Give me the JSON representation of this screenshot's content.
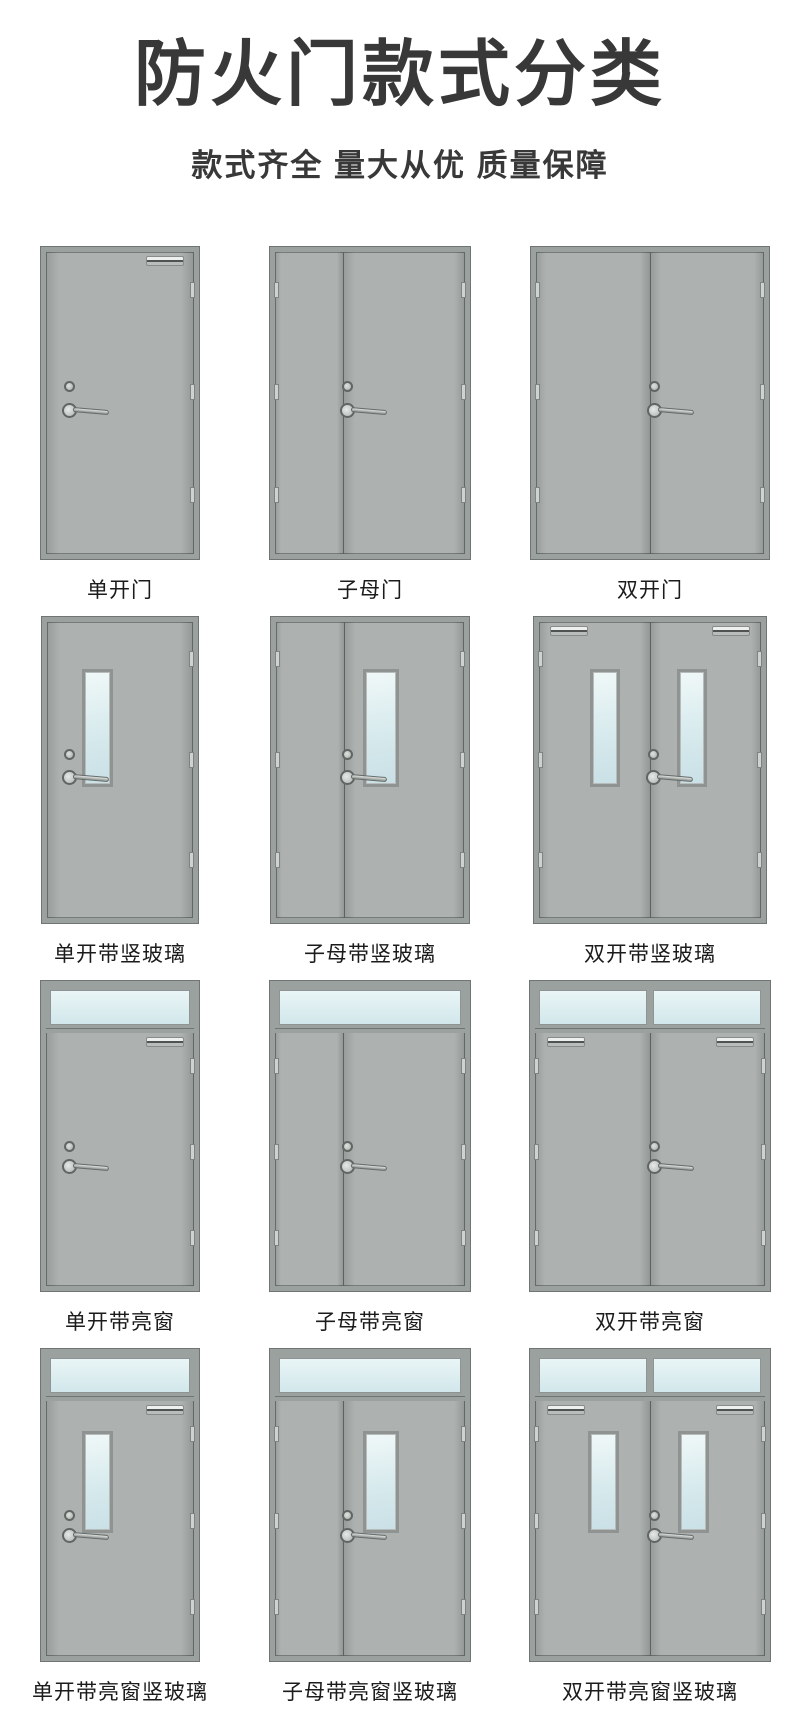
{
  "header": {
    "title": "防火门款式分类",
    "subtitle": "款式齐全 量大从优 质量保障"
  },
  "colors": {
    "background": "#ffffff",
    "title_text": "#383838",
    "label_text": "#1b1b1b",
    "door_fill": "#a9aeac",
    "frame": "#9ba19f",
    "frame_edge": "#707573",
    "glass_light": "#e9f5f6",
    "glass": "#d2e7eb",
    "hardware": "#616663"
  },
  "icons": {
    "door_closer": "closer-bar",
    "door_handle": "lever-handle",
    "door_lock": "cylinder-lock",
    "hinge": "hinge-plate"
  },
  "grid": {
    "rows": [
      {
        "cells": [
          {
            "label": "单开门",
            "kind": "single",
            "w": 158,
            "h": 312,
            "glass": false,
            "transom": false,
            "closer": true
          },
          {
            "label": "子母门",
            "kind": "mu",
            "w": 200,
            "h": 312,
            "glass": false,
            "transom": false,
            "closer": false
          },
          {
            "label": "双开门",
            "kind": "double",
            "w": 238,
            "h": 312,
            "glass": false,
            "transom": false,
            "closer": false
          }
        ]
      },
      {
        "cells": [
          {
            "label": "单开带竖玻璃",
            "kind": "single",
            "w": 156,
            "h": 306,
            "glass": true,
            "transom": false,
            "closer": false
          },
          {
            "label": "子母带竖玻璃",
            "kind": "mu",
            "w": 198,
            "h": 306,
            "glass": true,
            "transom": false,
            "closer": false
          },
          {
            "label": "双开带竖玻璃",
            "kind": "double",
            "w": 232,
            "h": 306,
            "glass": true,
            "transom": false,
            "closer": true
          }
        ]
      },
      {
        "cells": [
          {
            "label": "单开带亮窗",
            "kind": "single",
            "w": 158,
            "h": 310,
            "glass": false,
            "transom": true,
            "closer": true
          },
          {
            "label": "子母带亮窗",
            "kind": "mu",
            "w": 200,
            "h": 310,
            "glass": false,
            "transom": true,
            "closer": false
          },
          {
            "label": "双开带亮窗",
            "kind": "double",
            "w": 240,
            "h": 310,
            "glass": false,
            "transom": true,
            "closer": true
          }
        ]
      },
      {
        "cells": [
          {
            "label": "单开带亮窗竖玻璃",
            "kind": "single",
            "w": 158,
            "h": 312,
            "glass": true,
            "transom": true,
            "closer": true
          },
          {
            "label": "子母带亮窗竖玻璃",
            "kind": "mu",
            "w": 200,
            "h": 312,
            "glass": true,
            "transom": true,
            "closer": false
          },
          {
            "label": "双开带亮窗竖玻璃",
            "kind": "double",
            "w": 240,
            "h": 312,
            "glass": true,
            "transom": true,
            "closer": true
          }
        ]
      }
    ]
  }
}
